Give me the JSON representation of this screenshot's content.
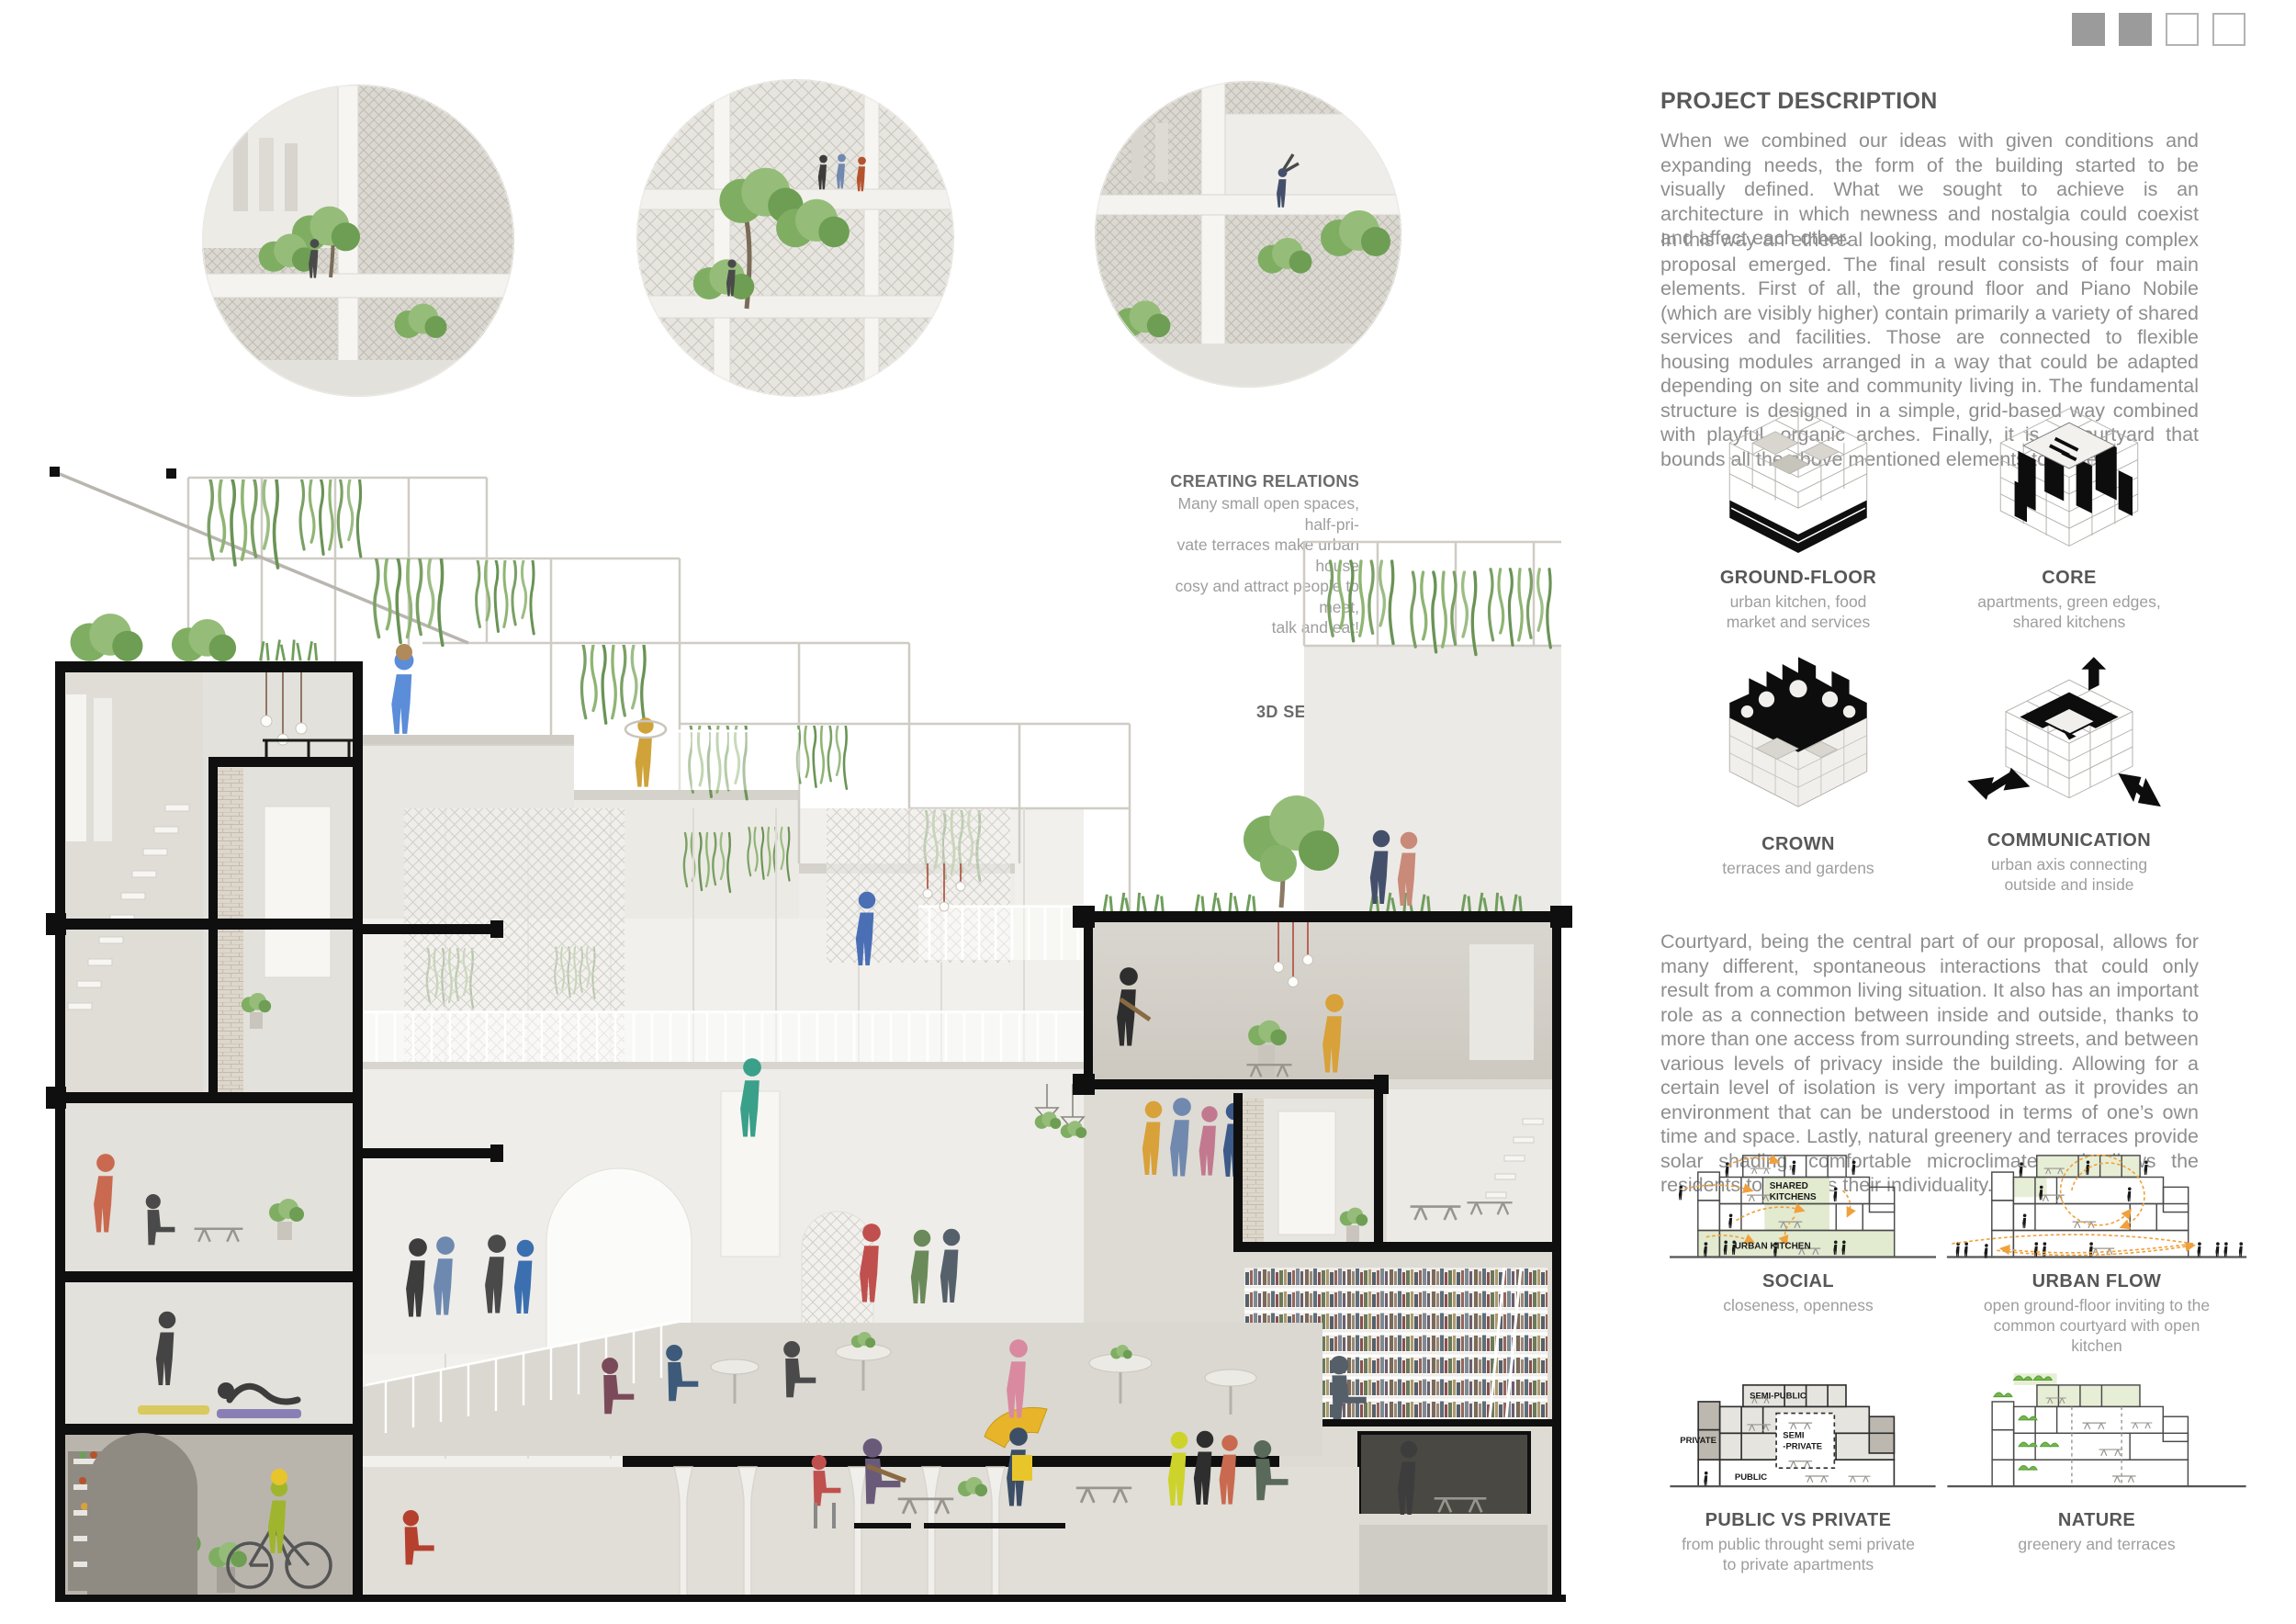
{
  "page_indicator": {
    "squares": [
      "filled",
      "filled",
      "empty",
      "empty"
    ]
  },
  "hero_images": [
    {
      "name": "render-balcony-gardening"
    },
    {
      "name": "render-atrium-terraces"
    },
    {
      "name": "render-balcony-greeting"
    }
  ],
  "creating_relations": {
    "title": "CREATING RELATIONS",
    "body": "Many small open spaces, half-pri-\nvate terraces make urban house\ncosy and attract people to meet,\ntalk and eat!"
  },
  "section_3d": {
    "label": "3D SECTION"
  },
  "project_description": {
    "title": "PROJECT DESCRIPTION",
    "paragraph1": "When we combined our ideas with given conditions and expanding needs, the form of the building started to be visually defined. What we sought to achieve is an architecture in which newness and nostalgia could coexist and affect each other.",
    "paragraph2": "In this way an ethereal looking, modular co-housing complex proposal emerged. The final result consists of four main elements. First of all, the ground floor and Piano Nobile (which are visibly higher) contain primarily a variety of shared services and facilities. Those are connected to flexible housing modules arranged in a way that could be adapted depending on site and community living in. The fundamental structure is designed in a simple, grid-based way combined with playful, organic arches. Finally, it is a courtyard that bounds all the above mentioned elements together.",
    "paragraph3": "Courtyard, being the central part of our proposal, allows for many different, spontaneous interactions that could only result from a common living situation. It also has an important role as a connection between inside and outside, thanks to more than one access from surrounding streets, and between various levels of privacy inside the building. Allowing for a certain level of isolation is very important as it provides an environment that can be understood in terms of one’s own time and space. Lastly, natural greenery and terraces provide solar shading, comfortable microclimate and allows the residents to express their individuality."
  },
  "element_diagrams": [
    {
      "title": "GROUND-FLOOR",
      "caption": "urban kitchen, food\nmarket and services"
    },
    {
      "title": "CORE",
      "caption": "apartments, green edges,\nshared kitchens"
    },
    {
      "title": "CROWN",
      "caption": "terraces and gardens"
    },
    {
      "title": "COMMUNICATION",
      "caption": "urban axis connecting\noutside and inside"
    }
  ],
  "concept_diagrams": [
    {
      "title": "SOCIAL",
      "caption": "closeness, openness",
      "labels": {
        "l1": "SHARED",
        "l2": "KITCHENS",
        "l3": "URBAN KITCHEN"
      }
    },
    {
      "title": "URBAN FLOW",
      "caption": "open ground-floor inviting to the\ncommon courtyard with open\nkitchen"
    },
    {
      "title": "PUBLIC VS PRIVATE",
      "caption": "from public throught semi private\nto private apartments",
      "labels": {
        "l1": "SEMI-PUBLIC",
        "l2": "PRIVATE",
        "l3": "SEMI",
        "l4": "-PRIVATE",
        "l5": "PUBLIC"
      }
    },
    {
      "title": "NATURE",
      "caption": "greenery and terraces"
    }
  ],
  "colors": {
    "accent_orange": "#f0a13c",
    "diagram_green": "#e2ead0",
    "bush_green": "#62a244",
    "frame_black": "#0f0f0f"
  }
}
